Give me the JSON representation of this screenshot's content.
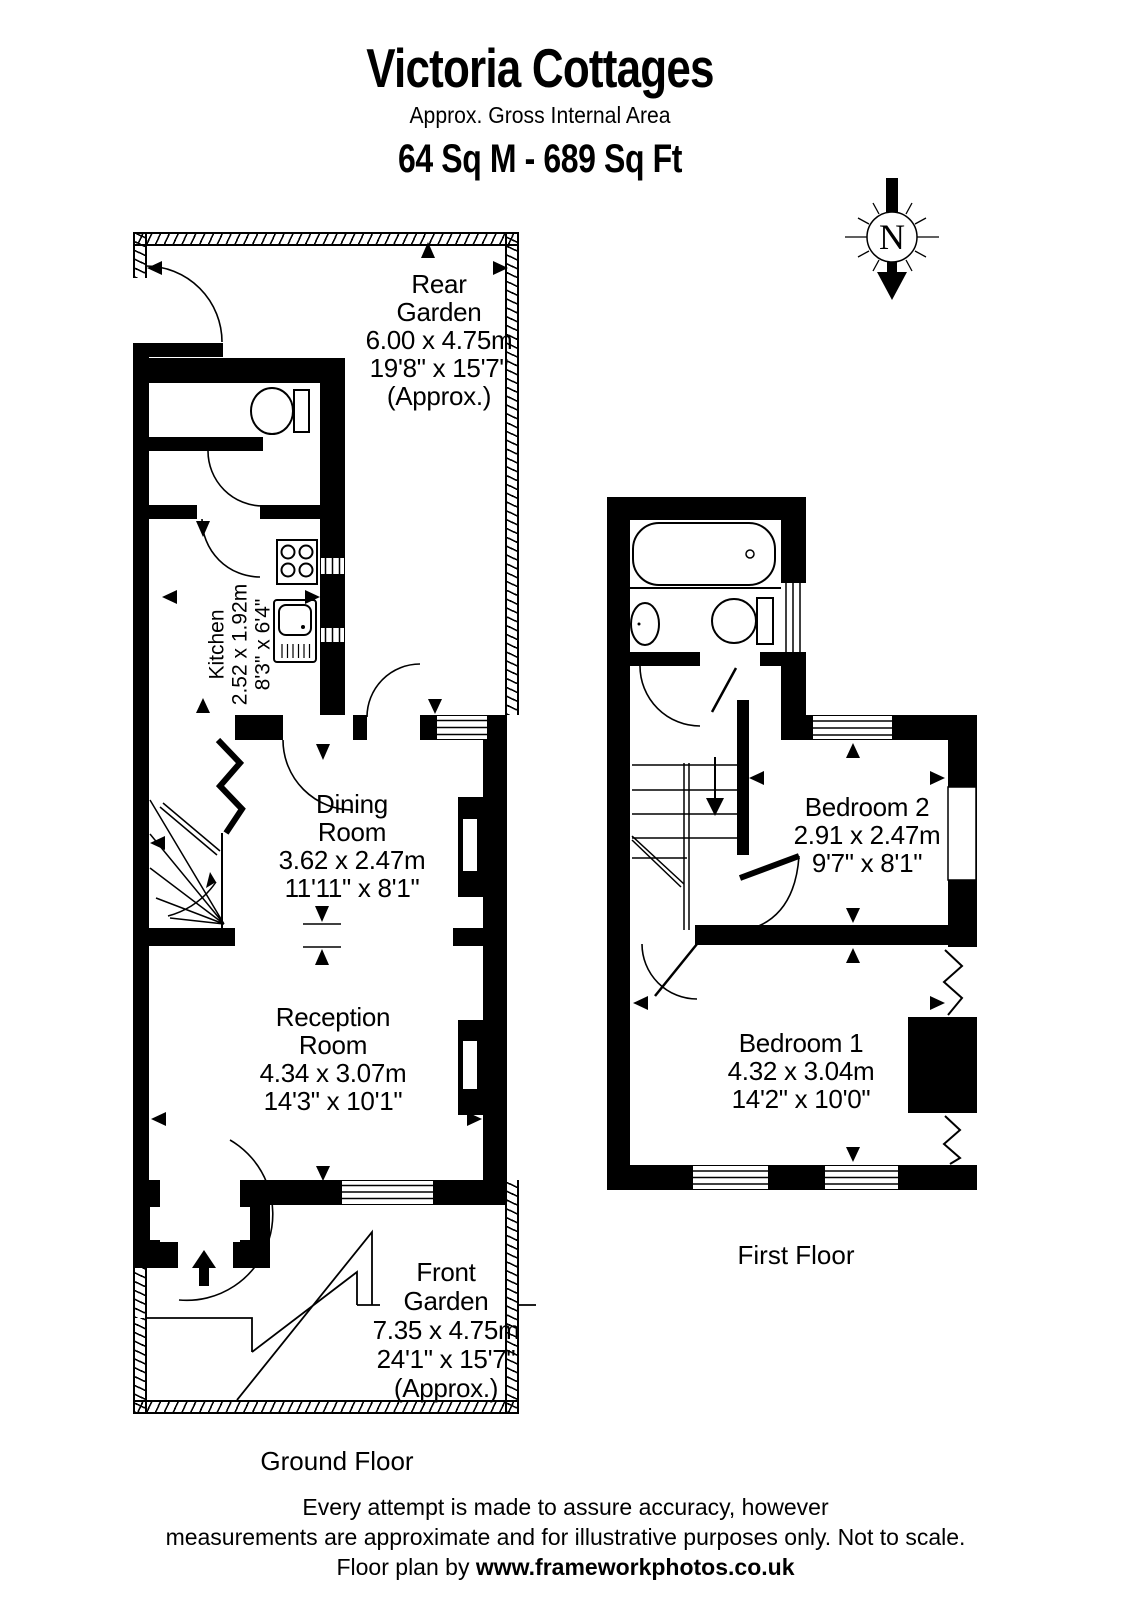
{
  "header": {
    "title": "Victoria Cottages",
    "subtitle": "Approx. Gross Internal Area",
    "area": "64 Sq M - 689 Sq Ft"
  },
  "compass": {
    "north_label": "N"
  },
  "ground_floor": {
    "label": "Ground Floor",
    "rooms": {
      "rear_garden": {
        "lines": [
          "Rear",
          "Garden",
          "6.00 x 4.75m",
          "19'8\" x 15'7\"",
          "(Approx.)"
        ]
      },
      "kitchen": {
        "lines": [
          "Kitchen",
          "2.52 x 1.92m",
          "8'3\" x 6'4\""
        ]
      },
      "dining_room": {
        "lines": [
          "Dining",
          "Room",
          "3.62 x 2.47m",
          "11'11\" x 8'1\""
        ]
      },
      "reception_room": {
        "lines": [
          "Reception",
          "Room",
          "4.34 x 3.07m",
          "14'3\" x 10'1\""
        ]
      },
      "front_garden": {
        "lines": [
          "Front",
          "Garden",
          "7.35 x 4.75m",
          "24'1\" x 15'7\"",
          "(Approx.)"
        ]
      }
    }
  },
  "first_floor": {
    "label": "First Floor",
    "rooms": {
      "bedroom_2": {
        "lines": [
          "Bedroom 2",
          "2.91 x 2.47m",
          "9'7\" x 8'1\""
        ]
      },
      "bedroom_1": {
        "lines": [
          "Bedroom 1",
          "4.32 x 3.04m",
          "14'2\" x 10'0\""
        ]
      }
    }
  },
  "footer": {
    "disclaimer_line1": "Every attempt is made to assure accuracy, however",
    "disclaimer_line2": "measurements are approximate and for illustrative purposes only. Not to scale.",
    "credit_prefix": "Floor plan by ",
    "credit_url": "www.frameworkphotos.co.uk"
  }
}
